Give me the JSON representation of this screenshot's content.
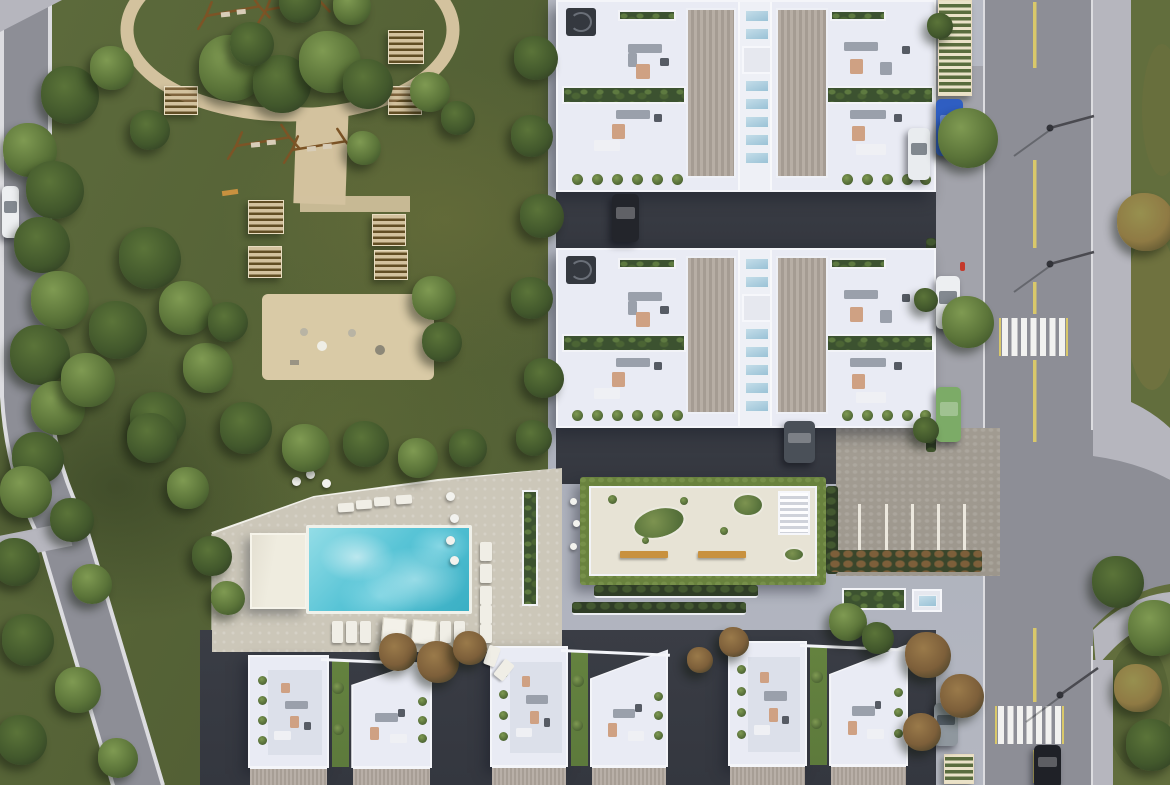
{
  "scene": {
    "type": "aerial architectural rendering",
    "description": "Top-down aerial render of a residential complex: community park with oval walking loop, swing sets and picnic pergolas on the left; two white apartment blocks with ribbed roofs, skylights and furnished roof terraces at top right; turquoise swimming pool with sun loungers and umbrellas; clubhouse roof garden with green edge; parking court with marked stalls; three clusters of white townhouses along the bottom; vertical street on the right with yellow center line, two zebra crosswalks, street lamps, parked cars and a green verge.",
    "areas": [
      {
        "id": "park",
        "label": "community park"
      },
      {
        "id": "playground-oval",
        "label": "oval walking loop with swings"
      },
      {
        "id": "picnic-area",
        "label": "picnic pergola court"
      },
      {
        "id": "central-plaza",
        "label": "sandy plaza"
      },
      {
        "id": "apartment-block-north",
        "label": "north apartment block roof"
      },
      {
        "id": "apartment-block-mid",
        "label": "middle apartment block roof"
      },
      {
        "id": "clubhouse-roof-garden",
        "label": "clubhouse green roof terrace"
      },
      {
        "id": "pool-deck",
        "label": "pool deck"
      },
      {
        "id": "swimming-pool",
        "label": "swimming pool"
      },
      {
        "id": "pool-house",
        "label": "pool house"
      },
      {
        "id": "parking-court",
        "label": "parking court"
      },
      {
        "id": "townhouse-row",
        "label": "townhouse clusters"
      },
      {
        "id": "east-street",
        "label": "east street with crosswalks"
      },
      {
        "id": "west-road",
        "label": "west road"
      }
    ],
    "vehicles": [
      {
        "name": "black-car-north-driveway",
        "color": "#23252b"
      },
      {
        "name": "grey-van-south-driveway",
        "color": "#4a5058"
      },
      {
        "name": "white-car-west-road",
        "color": "#edeff1"
      },
      {
        "name": "blue-car-east-layby",
        "color": "#2f5ec2"
      },
      {
        "name": "white-car-east-garage",
        "color": "#e9ecef"
      },
      {
        "name": "white-car-east-layby",
        "color": "#edeff1"
      },
      {
        "name": "green-car-east-layby",
        "color": "#7cab67"
      },
      {
        "name": "grey-car-southeast",
        "color": "#8f979e"
      },
      {
        "name": "black-car-east-road",
        "color": "#1f2127"
      }
    ],
    "counts": {
      "apartment_blocks": 2,
      "townhouse_clusters": 3,
      "crosswalks": 2,
      "swimming_pools": 1,
      "picnic_pergolas": 7,
      "swing_sets": 4,
      "street_lamps": 3,
      "parking_stall_lines": 5,
      "vehicles": 9
    }
  },
  "colors": {
    "park": "#59673a",
    "field": "#626e3d",
    "sand": "#d3c29e",
    "plaza": "#d9caa6",
    "road": "#8d8e96",
    "sidewalk": "#b6b6be",
    "curb": "#dcdce0",
    "pavement": "#b7bac4",
    "asphalt": "#34373f",
    "deck": "#ccc7b9",
    "poolWater": "#58c4d6",
    "poolDeep": "#3aafc4",
    "poolLight": "#aee8ee",
    "poolhouse": "#efecdf",
    "building": "#e9ebf4",
    "buildingEdge": "#f4f5f9",
    "terrace": "#dce0ea",
    "ribbed1": "#b7aea5",
    "ribbed2": "#a59c93",
    "skylight1": "#c4dde9",
    "skylight2": "#9ac2d6",
    "planter": "#3c5230",
    "grassStrip": "#5d7a3c",
    "grassRoof": "#69823e",
    "courtyard": "#e7e3d5",
    "parking": "#9c968c",
    "stall": "#ece8de",
    "yellow": "#d9c86a",
    "stripe": "#f2f2f0",
    "hedge": "#2f3d26",
    "bench": "#c8913f",
    "wood": "#7c5426",
    "treeL": "#7f9a52",
    "treeM": "#5b7439",
    "treeD": "#42582c",
    "autumn": "#8f7a44",
    "redleaf": "#7d5f3a",
    "hydrant": "#c43a2c",
    "furnGrey": "#9aa0ab",
    "furnTan": "#cfa183",
    "furnWhite": "#eff0f4",
    "furnDark": "#565b64"
  }
}
